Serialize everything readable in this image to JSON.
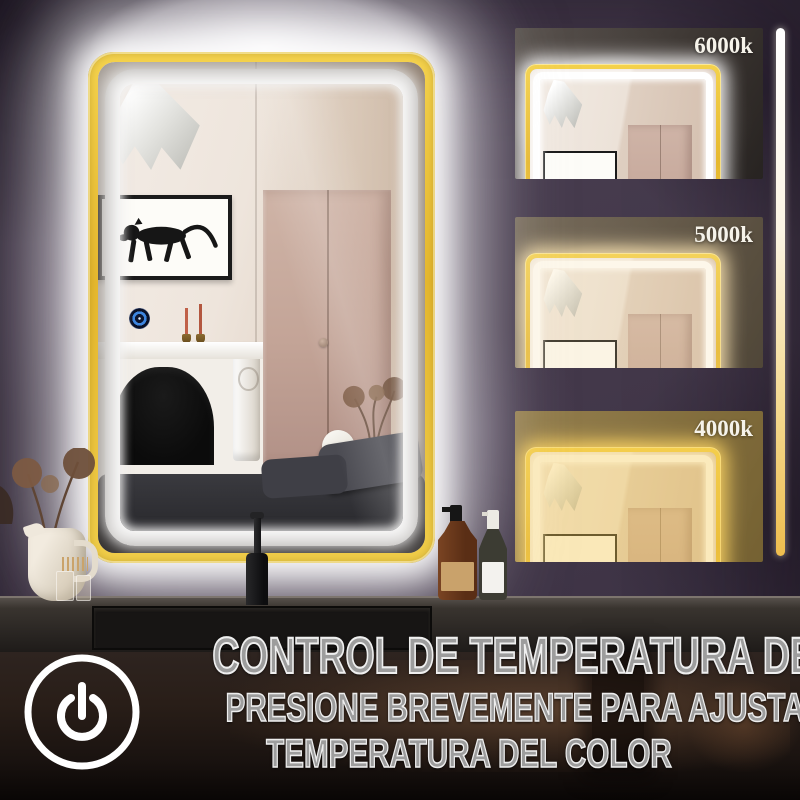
{
  "colors": {
    "wall": "#43384a",
    "gold_frame": "#e7b92f",
    "gold_frame_light": "#f6d44e",
    "led_white": "#ffffff",
    "text_gray": "#9d9d9d",
    "slider_top": "#ffffff",
    "slider_middle": "#fbf4e4",
    "slider_bottom": "#eebd4e"
  },
  "thumbnails": [
    {
      "label": "6000k",
      "tone": "cool",
      "glow_color": "rgba(255,255,255,0.95)",
      "tint_color": "rgba(255,255,255,0)"
    },
    {
      "label": "5000k",
      "tone": "neutral",
      "glow_color": "rgba(246,226,180,0.95)",
      "tint_color": "rgba(246,215,150,0.20)"
    },
    {
      "label": "4000k",
      "tone": "warm",
      "glow_color": "rgba(242,207,106,0.98)",
      "tint_color": "rgba(244,200,80,0.38)"
    }
  ],
  "slider": {
    "description": "color-temperature-gradient-bar"
  },
  "footer": {
    "title": "CONTROL DE TEMPERATURA DE COLOR",
    "line2": "PRESIONE BREVEMENTE PARA AJUSTAR LA",
    "line3": "TEMPERATURA DEL COLOR"
  },
  "icons": {
    "power": "power-icon",
    "touch_sensor": "touch-sensor-icon"
  },
  "scene": {
    "items": [
      "pendant-lamp",
      "panther-artwork",
      "candlesticks",
      "fireplace-mantel",
      "wardrobe",
      "dried-flowers",
      "table-lamp",
      "bed",
      "touch-sensor"
    ],
    "foreground_items": [
      "white-pitcher-with-dried-flowers",
      "match-jars",
      "black-faucet",
      "amber-pump-bottle",
      "spray-bottle"
    ]
  }
}
